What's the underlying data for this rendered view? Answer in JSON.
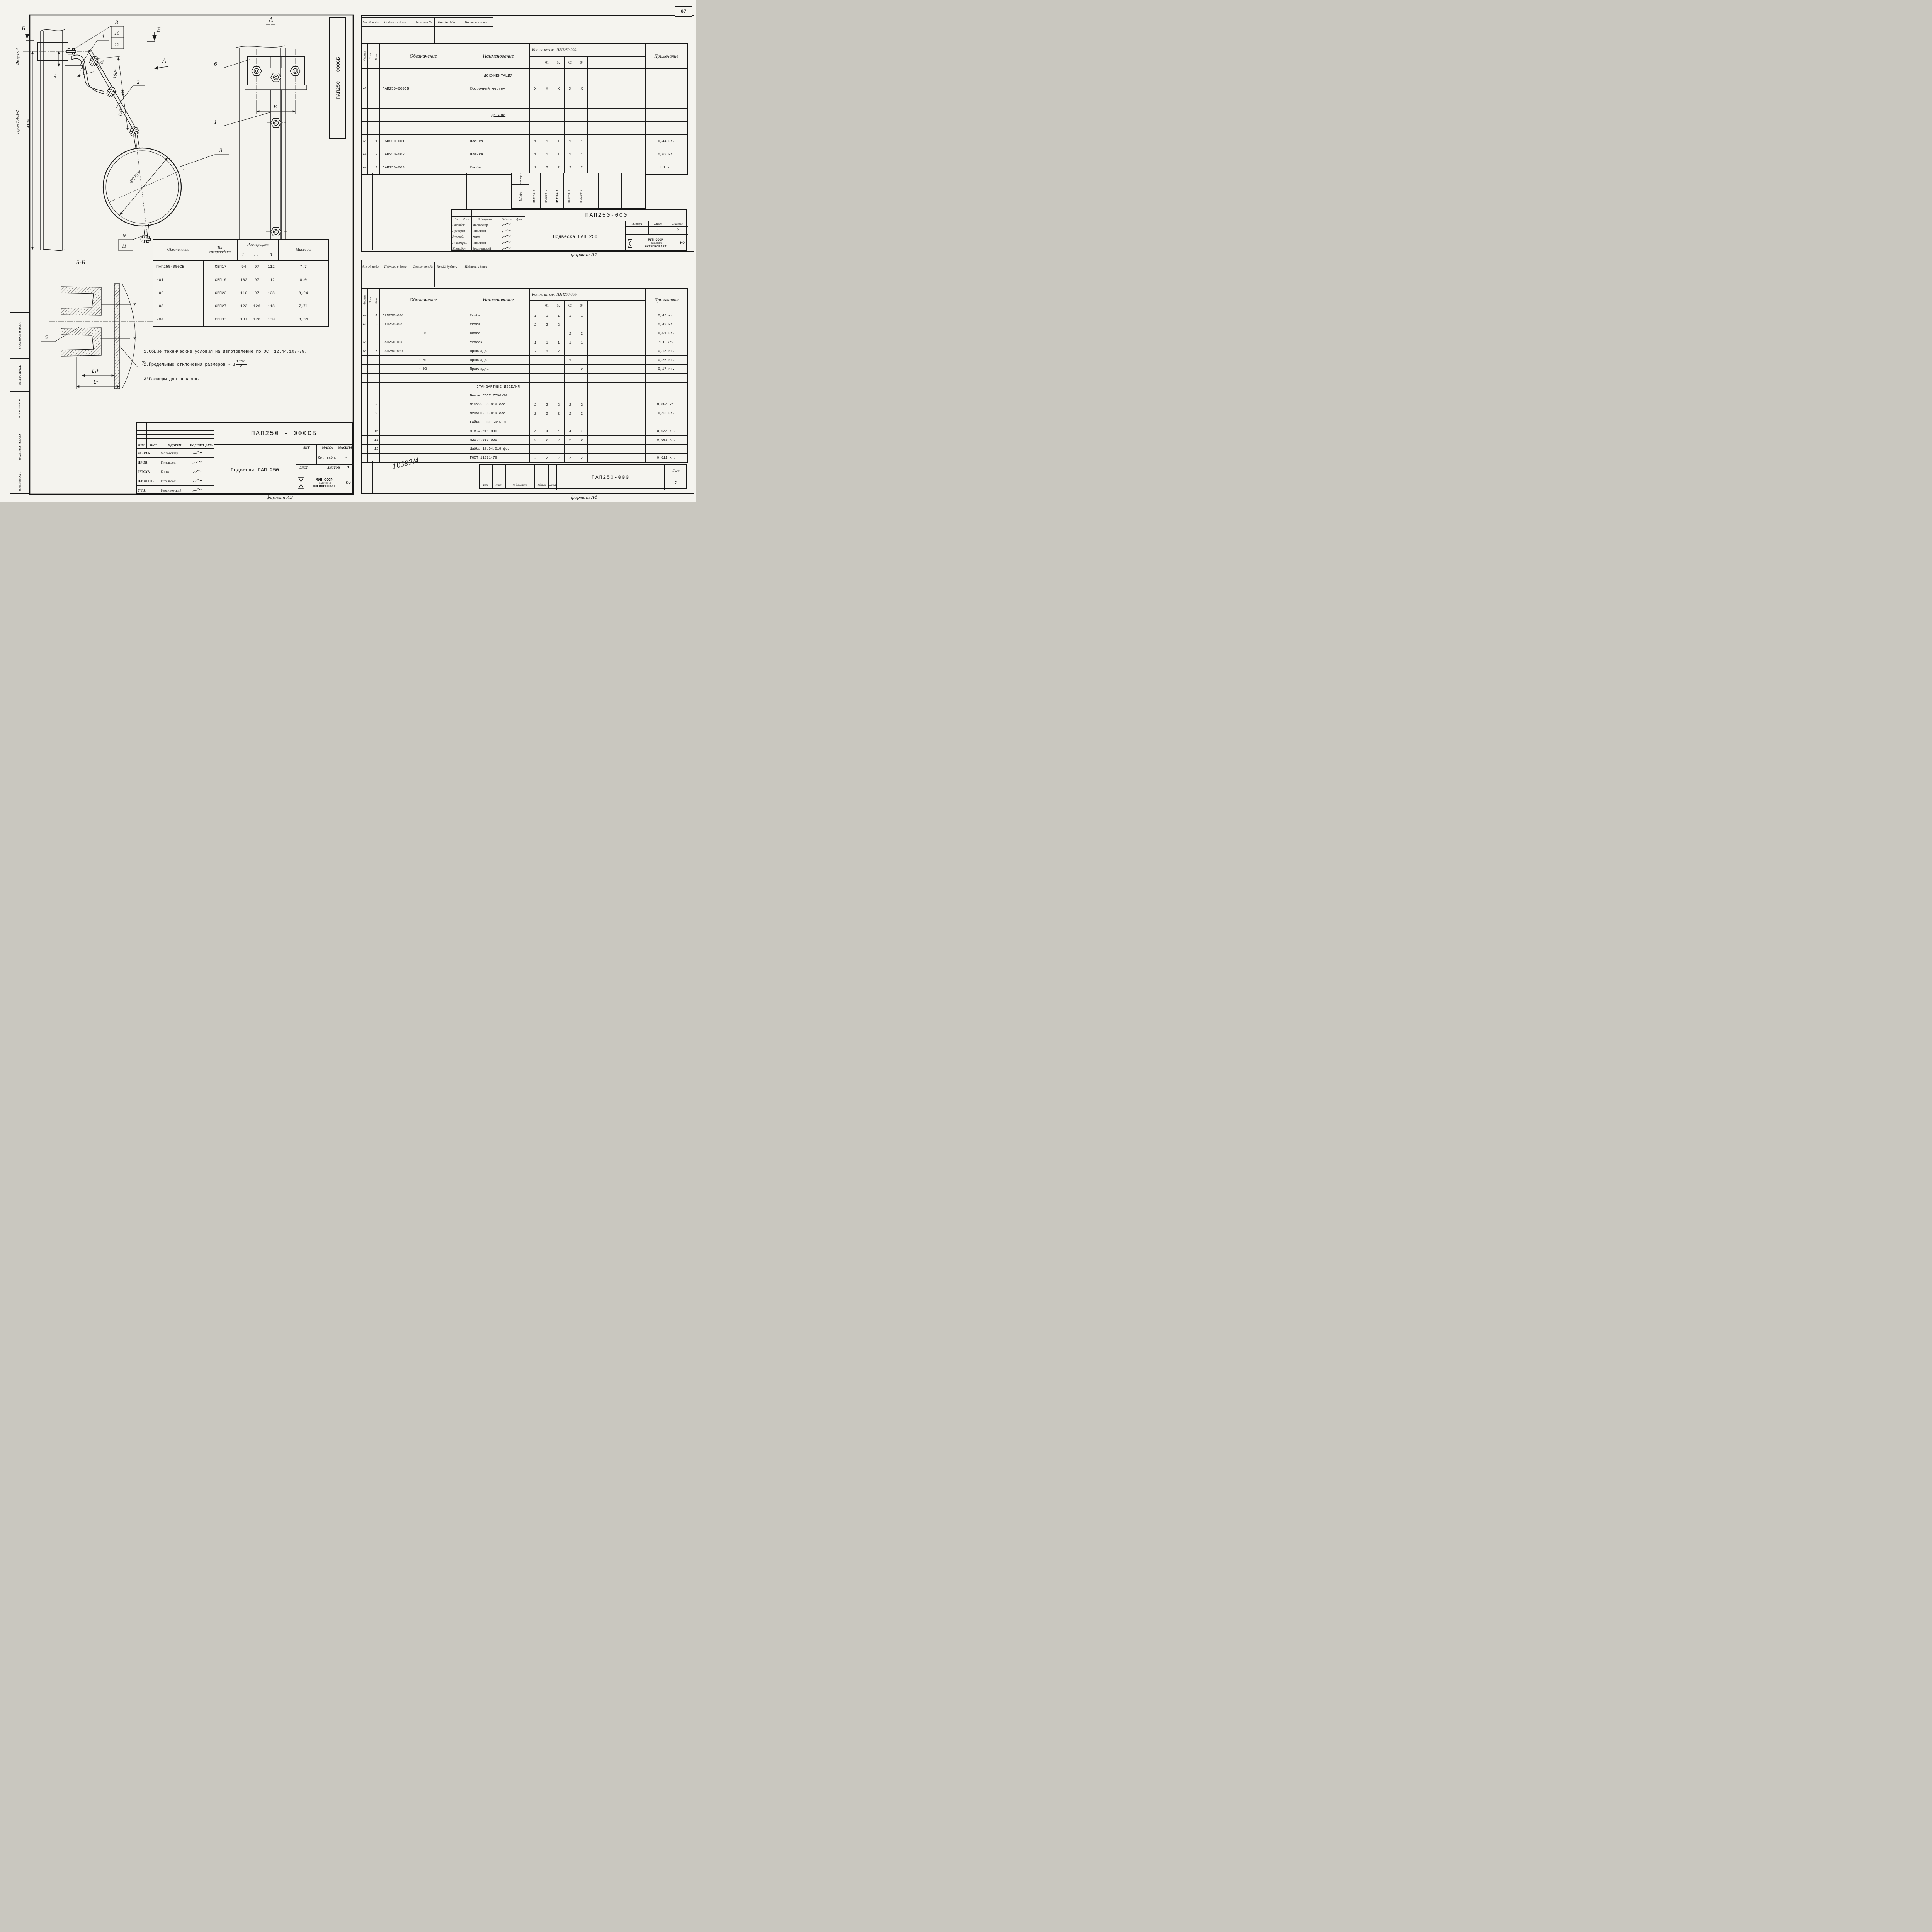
{
  "page": {
    "number": "67",
    "format_a3": "формат А3",
    "format_a4_top": "формат А4",
    "format_a4_bottom": "формат А4"
  },
  "margin": {
    "vypusk": "Выпуск 4",
    "seriya": "серия 7.401-2",
    "stamp": [
      "ПОДПИСЬ И ДАТА",
      "ИНВ.№ ДУБЛ.",
      "ВЗАМ.ИНВ.№",
      "ПОДПИСЬ И ДАТА",
      "ИНВ.№ПОДЛ."
    ]
  },
  "drawing": {
    "vertical_doc": "ПАП250 - 000СБ",
    "sec_b_left": "Б",
    "sec_b_right": "Б",
    "view_a_arrow": "А",
    "view_a_title": "А",
    "section_bb_title": "Б-Б",
    "callouts": {
      "c1": "1",
      "c2": "2",
      "c3": "3",
      "c4": "4",
      "c5": "5",
      "c6": "6",
      "c7": "7",
      "c8": "8",
      "c9": "9",
      "c10": "10",
      "c11": "11",
      "c12": "12"
    },
    "dims": {
      "d412": "412*",
      "d45": "45",
      "d50": "50",
      "d10": "10*",
      "d100": "100*",
      "d120": "120*",
      "dia": "Ф275*",
      "B": "В",
      "L1": "L₁*",
      "L": "L*",
      "weld1": "IX",
      "weld2": "IX"
    }
  },
  "notes": {
    "n1": "1.Общие технические условия на изготовление по ОСТ 12.44.107-79.",
    "n2": "2.Предельные отклонения размеров -",
    "n2_pm": "±",
    "n2_num": "IT16",
    "n2_den": "2",
    "n3": "3*Размеры для справок."
  },
  "params_table": {
    "h_obozn": "Обозначение",
    "h_tip1": "Тип",
    "h_tip2": "спецпрофиля",
    "h_razm": "Размеры,мм",
    "h_L": "L",
    "h_L1": "L₁",
    "h_B": "В",
    "h_massa": "Масса,кг",
    "rows": [
      [
        "ПАП250-000СБ",
        "СВП17",
        "94",
        "97",
        "112",
        "7,7"
      ],
      [
        "-01",
        "СВП19",
        "102",
        "97",
        "112",
        "8,0"
      ],
      [
        "-02",
        "СВП22",
        "110",
        "97",
        "128",
        "8,24"
      ],
      [
        "-03",
        "СВП27",
        "123",
        "126",
        "118",
        "7,71"
      ],
      [
        "-04",
        "СВП33",
        "137",
        "126",
        "130",
        "8,34"
      ]
    ]
  },
  "tb_a3": {
    "doc": "ПАП250 - 000СБ",
    "title": "Подвеска ПАП 250",
    "cols": [
      "ИЗМ.",
      "ЛИСТ",
      "№ДОКУМ.",
      "ПОДПИСЬ",
      "ДАТА"
    ],
    "people": [
      [
        "РАЗРАБ.",
        "Молокошер"
      ],
      [
        "ПРОВ.",
        "Гительзон"
      ],
      [
        "РУКОВ.",
        "Коток"
      ],
      [
        "Н.КОНТР.",
        "Гительзон"
      ],
      [
        "УТВ.",
        "Бердичевский"
      ]
    ],
    "lit": "ЛИТ",
    "massa": "МАССА",
    "masshtab": "МАСШТАБ",
    "massa_val": "См. табл.",
    "masshtab_val": "-",
    "list": "ЛИСТ",
    "listov": "ЛИСТОВ",
    "listov_val": "1",
    "org1": "МУП  СССР",
    "org2": "ГлавУПиКС",
    "org3": "ЮЖГИПРОШАХТ",
    "ko": "КО"
  },
  "spec_head": {
    "format": "Формат",
    "zona": "Зона",
    "poz": "Позиц.",
    "obozn": "Обозначение",
    "naim": "Наименование",
    "kol": "Кол. на исполн.  ПАП250-000-",
    "exec": [
      "-",
      "01",
      "02",
      "03",
      "04"
    ],
    "prim": "Примечание"
  },
  "spec1": {
    "strip": [
      "Инв. № подл.",
      "Подпись и дата",
      "Взам. инв.№",
      "Инв. № дубл.",
      "Подпись и дата"
    ],
    "rows": [
      {
        "format": "",
        "poz": "",
        "obozn": "",
        "naim": "ДОКУМЕНТАЦИЯ",
        "qty": [
          "",
          "",
          "",
          "",
          ""
        ],
        "prim": "",
        "cls": "sec"
      },
      {
        "format": "А3",
        "poz": "",
        "obozn": "ПАП250-000СБ",
        "naim": "Сборочный чертеж",
        "qty": [
          "X",
          "X",
          "X",
          "X",
          "X"
        ],
        "prim": ""
      },
      {
        "format": "",
        "poz": "",
        "obozn": "",
        "naim": "",
        "qty": [
          "",
          "",
          "",
          "",
          ""
        ],
        "prim": ""
      },
      {
        "format": "",
        "poz": "",
        "obozn": "",
        "naim": "ДЕТАЛИ",
        "qty": [
          "",
          "",
          "",
          "",
          ""
        ],
        "prim": "",
        "cls": "sec"
      },
      {
        "format": "",
        "poz": "",
        "obozn": "",
        "naim": "",
        "qty": [
          "",
          "",
          "",
          "",
          ""
        ],
        "prim": ""
      },
      {
        "format": "А4",
        "poz": "1",
        "obozn": "ПАП250-001",
        "naim": "Планка",
        "qty": [
          "1",
          "1",
          "1",
          "1",
          "1"
        ],
        "prim": "0,44 кг."
      },
      {
        "format": "А4",
        "poz": "2",
        "obozn": "ПАП250-002",
        "naim": "Планка",
        "qty": [
          "1",
          "1",
          "1",
          "1",
          "1"
        ],
        "prim": "0,63 кг."
      },
      {
        "format": "А4",
        "poz": "3",
        "obozn": "ПАП250-003",
        "naim": "Скоба",
        "qty": [
          "2",
          "2",
          "2",
          "2",
          "2"
        ],
        "prim": "1,1 кг."
      }
    ],
    "litera": "Литера",
    "shifr": "Шифр",
    "shifr_vals": [
      "ПАП250-1",
      "ПАП250-2",
      "ПАП250-3",
      "ПАП250-4",
      "ПАП250-5"
    ],
    "tb": {
      "doc": "ПАП250-000",
      "cols": [
        "Изм.",
        "Лист",
        "№ документ.",
        "Подпись",
        "Дата"
      ],
      "people": [
        [
          "Разработ.",
          "Молокошер"
        ],
        [
          "Проверил",
          "Гительзон"
        ],
        [
          "Руковод.",
          "Коток"
        ],
        [
          "Н.контрол.",
          "Гительзон"
        ],
        [
          "Утвердил",
          "Бердичевский"
        ]
      ],
      "title": "Подвеска ПАП 250",
      "litera": "Литера",
      "list": "Лист",
      "listov": "Листов",
      "list_val": "1",
      "listov_val": "2",
      "org1": "МУП  СССР",
      "org2": "ГлавУПиКС",
      "org3": "ЮЖГИПРОШАХТ",
      "ko": "КО"
    }
  },
  "spec2": {
    "strip": [
      "Инв. № подл.",
      "Подпись и дата",
      "Взамен инв.№",
      "Инв.№ дублик.",
      "Подпись и дата"
    ],
    "rows": [
      {
        "format": "А4",
        "poz": "4",
        "obozn": "ПАП250-004",
        "naim": "Скоба",
        "qty": [
          "1",
          "1",
          "1",
          "1",
          "1"
        ],
        "prim": "0,45 кг."
      },
      {
        "format": "А3",
        "poz": "5",
        "obozn": "ПАП250-005",
        "naim": "Скоба",
        "qty": [
          "2",
          "2",
          "2",
          "",
          ""
        ],
        "prim": "0,43 кг."
      },
      {
        "format": "",
        "poz": "",
        "obozn": "- 01",
        "naim": "Скоба",
        "qty": [
          "",
          "",
          "",
          "2",
          "2"
        ],
        "prim": "0,51 кг.",
        "cls": "sub"
      },
      {
        "format": "А4",
        "poz": "6",
        "obozn": "ПАП250-006",
        "naim": "Уголок",
        "qty": [
          "1",
          "1",
          "1",
          "1",
          "1"
        ],
        "prim": "1,8 кг."
      },
      {
        "format": "А4",
        "poz": "7",
        "obozn": "ПАП250-007",
        "naim": "Прокладка",
        "qty": [
          "-",
          "2",
          "2",
          "",
          ""
        ],
        "prim": "0,13 кг."
      },
      {
        "format": "",
        "poz": "",
        "obozn": "- 01",
        "naim": "Прокладка",
        "qty": [
          "",
          "",
          "",
          "2",
          ""
        ],
        "prim": "0,26 кг.",
        "cls": "sub"
      },
      {
        "format": "",
        "poz": "",
        "obozn": "- 02",
        "naim": "Прокладка",
        "qty": [
          "",
          "",
          "",
          "",
          "2"
        ],
        "prim": "0,17 кг.",
        "cls": "sub"
      },
      {
        "format": "",
        "poz": "",
        "obozn": "",
        "naim": "",
        "qty": [
          "",
          "",
          "",
          "",
          ""
        ],
        "prim": ""
      },
      {
        "format": "",
        "poz": "",
        "obozn": "",
        "naim": "СТАНДАРТНЫЕ ИЗДЕЛИЯ",
        "qty": [
          "",
          "",
          "",
          "",
          ""
        ],
        "prim": "",
        "cls": "sec"
      },
      {
        "format": "",
        "poz": "",
        "obozn": "",
        "naim": "Болты ГОСТ 7796-70",
        "qty": [
          "",
          "",
          "",
          "",
          ""
        ],
        "prim": ""
      },
      {
        "format": "",
        "poz": "8",
        "obozn": "",
        "naim": "М16х35.66.019 фос",
        "qty": [
          "2",
          "2",
          "2",
          "2",
          "2"
        ],
        "prim": "0,084 кг."
      },
      {
        "format": "",
        "poz": "9",
        "obozn": "",
        "naim": "М20х50.66.019 фос",
        "qty": [
          "2",
          "2",
          "2",
          "2",
          "2"
        ],
        "prim": "0,16 кг."
      },
      {
        "format": "",
        "poz": "",
        "obozn": "",
        "naim": "Гайки ГОСТ 5915-70",
        "qty": [
          "",
          "",
          "",
          "",
          ""
        ],
        "prim": ""
      },
      {
        "format": "",
        "poz": "10",
        "obozn": "",
        "naim": "М16.4.019 фос",
        "qty": [
          "4",
          "4",
          "4",
          "4",
          "4"
        ],
        "prim": "0,033 кг."
      },
      {
        "format": "",
        "poz": "11",
        "obozn": "",
        "naim": "М20.4.019 фос",
        "qty": [
          "2",
          "2",
          "2",
          "2",
          "2"
        ],
        "prim": "0,063 кг."
      },
      {
        "format": "",
        "poz": "12",
        "obozn": "",
        "naim": "Шайба 16.04.019 фос",
        "qty": [
          "",
          "",
          "",
          "",
          ""
        ],
        "prim": ""
      },
      {
        "format": "",
        "poz": "",
        "obozn": "",
        "naim": "ГОСТ 11371-78",
        "qty": [
          "2",
          "2",
          "2",
          "2",
          "2"
        ],
        "prim": "0,011 кг."
      }
    ],
    "handwritten": "10392/4",
    "tb": {
      "doc": "ПАП250-000",
      "cols": [
        "Изм.",
        "Лист",
        "№ документ",
        "Подпись",
        "Дата"
      ],
      "list": "Лист",
      "list_val": "2"
    }
  }
}
